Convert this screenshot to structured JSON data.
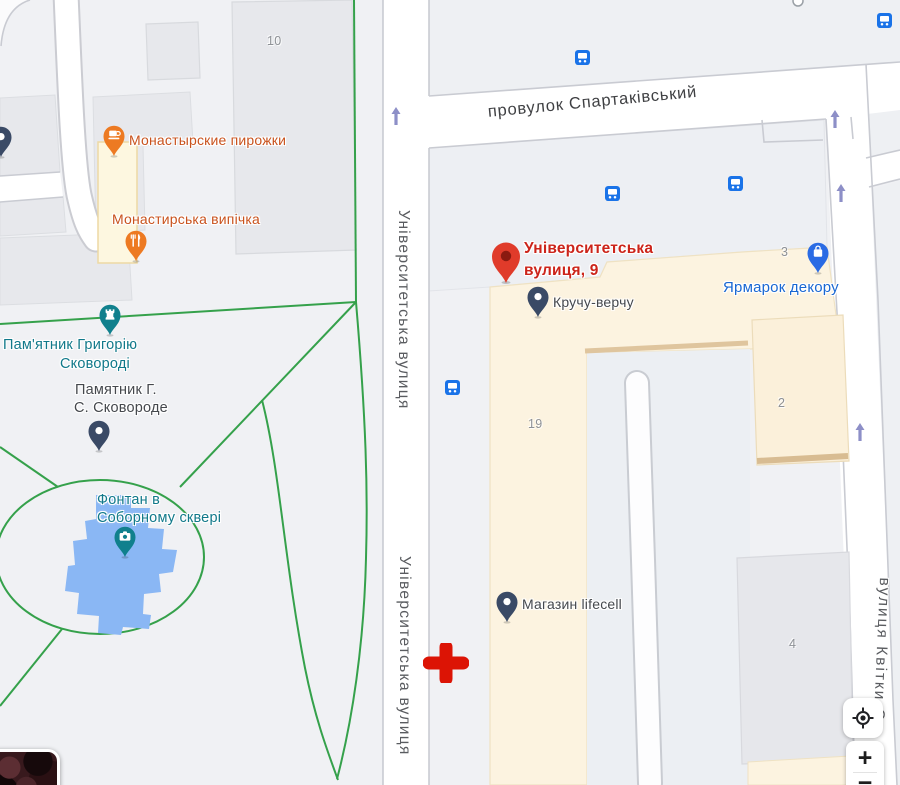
{
  "streets": {
    "spartakivskyi": "провулок Спартаківський",
    "universytetska_1": "Університетська вулиця",
    "universytetska_2": "Університетська вулиця",
    "kvitky": "вулиця Квітки-С"
  },
  "house_numbers": {
    "b10": "10",
    "b3": "3",
    "b2": "2",
    "b19": "19",
    "b4": "4"
  },
  "pois": {
    "monastyrskie_pirozhki": {
      "label": "Монастырские пирожки",
      "icon": "cafe-icon",
      "color": "#ed7a22"
    },
    "monastyrska_vypichka": {
      "label": "Монастирська випічка",
      "icon": "restaurant-icon",
      "color": "#ed7a22"
    },
    "pamyatnyk_hryhoriyu": {
      "line1": "Пам'ятник Григорію",
      "line2": "Сковороді",
      "icon": "castle-icon",
      "color": "#10808d"
    },
    "pamyatnik_gs": {
      "line1": "Памятник Г.",
      "line2": "С. Сковороде",
      "icon": "dot-icon",
      "color": "#3a4a66"
    },
    "fontan": {
      "line1": "Фонтан в",
      "line2": "Соборному сквері",
      "icon": "camera-icon",
      "color": "#10808d"
    },
    "kruchu_verchu": {
      "label": "Кручу-верчу",
      "icon": "dot-icon",
      "color": "#3a4a66"
    },
    "lifecell": {
      "label": "Магазин lifecell",
      "icon": "dot-icon",
      "color": "#3a4a66"
    },
    "yarmarok_dekoru": {
      "label": "Ярмарок декору",
      "icon": "shopping-bag-icon",
      "color": "#2a6be4"
    }
  },
  "destination": {
    "line1": "Університетська",
    "line2": "вулиця, 9",
    "pin_color": "#e03b2a",
    "label_color": "#cc241a"
  },
  "controls": {
    "zoom_in_label": "+",
    "zoom_out_label": "−"
  },
  "colors": {
    "land": "#f0f1f4",
    "road_fill": "#ffffff",
    "road_casing": "#c9cbd2",
    "building_gray": "#e7e8ec",
    "commercial_area": "#fcf3e0",
    "park_path_green": "#35a14b",
    "water_blue": "#8ab7f4",
    "bus_icon_blue": "#1a73e8",
    "one_way_arrow": "#8d8fc7",
    "cursor_cross_red": "#dc1405",
    "street_label": "#5a5c60",
    "label_blue": "#1967d2"
  }
}
